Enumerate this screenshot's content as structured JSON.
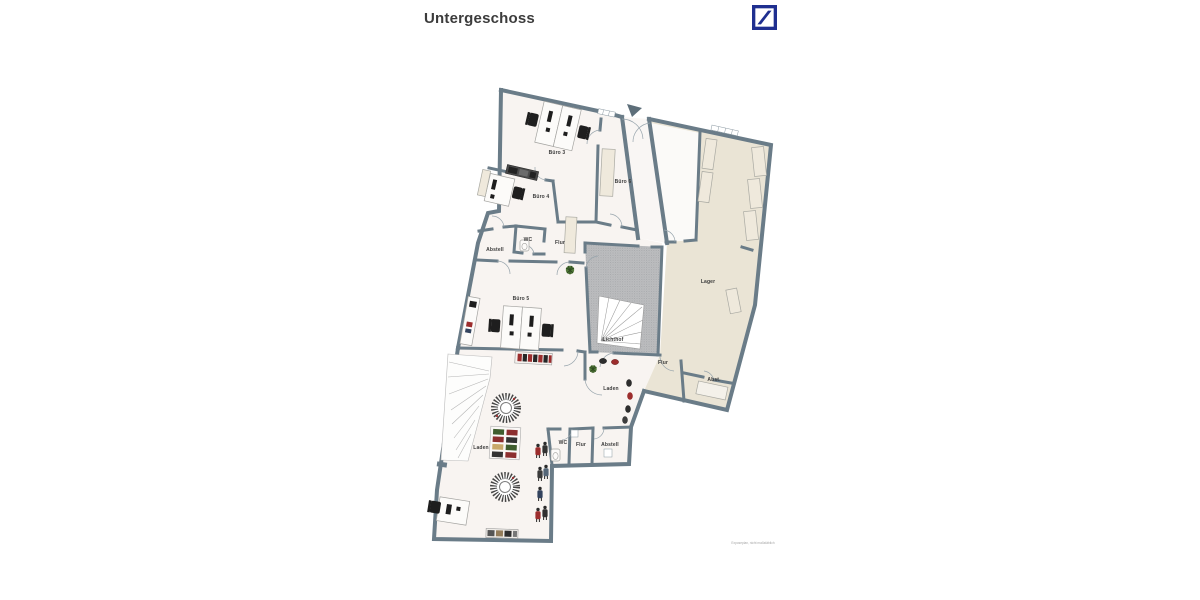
{
  "page": {
    "title": "Untergeschoss",
    "footer_note": "Exposeplan, nicht maßstäblich"
  },
  "logo": {
    "name": "Deutsche Bank logo",
    "color": "#1f2f90"
  },
  "colors": {
    "wall": "#6a7c88",
    "office_floor": "#f8f4f1",
    "lager_floor": "#eae4d5",
    "lichthof_floor": "#bcbdbf",
    "accent_red": "#9c2d2d",
    "plant_green": "#41682f",
    "db_blue": "#1f2f90"
  },
  "rooms": {
    "buero3": "Büro 3",
    "buero4": "Büro 4",
    "buero6": "Büro 6",
    "wc_og": "WC",
    "flur_og": "Flur",
    "abstell_og": "Abstell",
    "buero5": "Büro 5",
    "lichthof": "Lichthof",
    "lager": "Lager",
    "flur_right": "Flur",
    "abst_right": "Abst.",
    "laden_upper": "Laden",
    "laden_main": "Laden",
    "wc_shop": "WC",
    "flur_shop": "Flur",
    "abstell_shop": "Abstell"
  }
}
